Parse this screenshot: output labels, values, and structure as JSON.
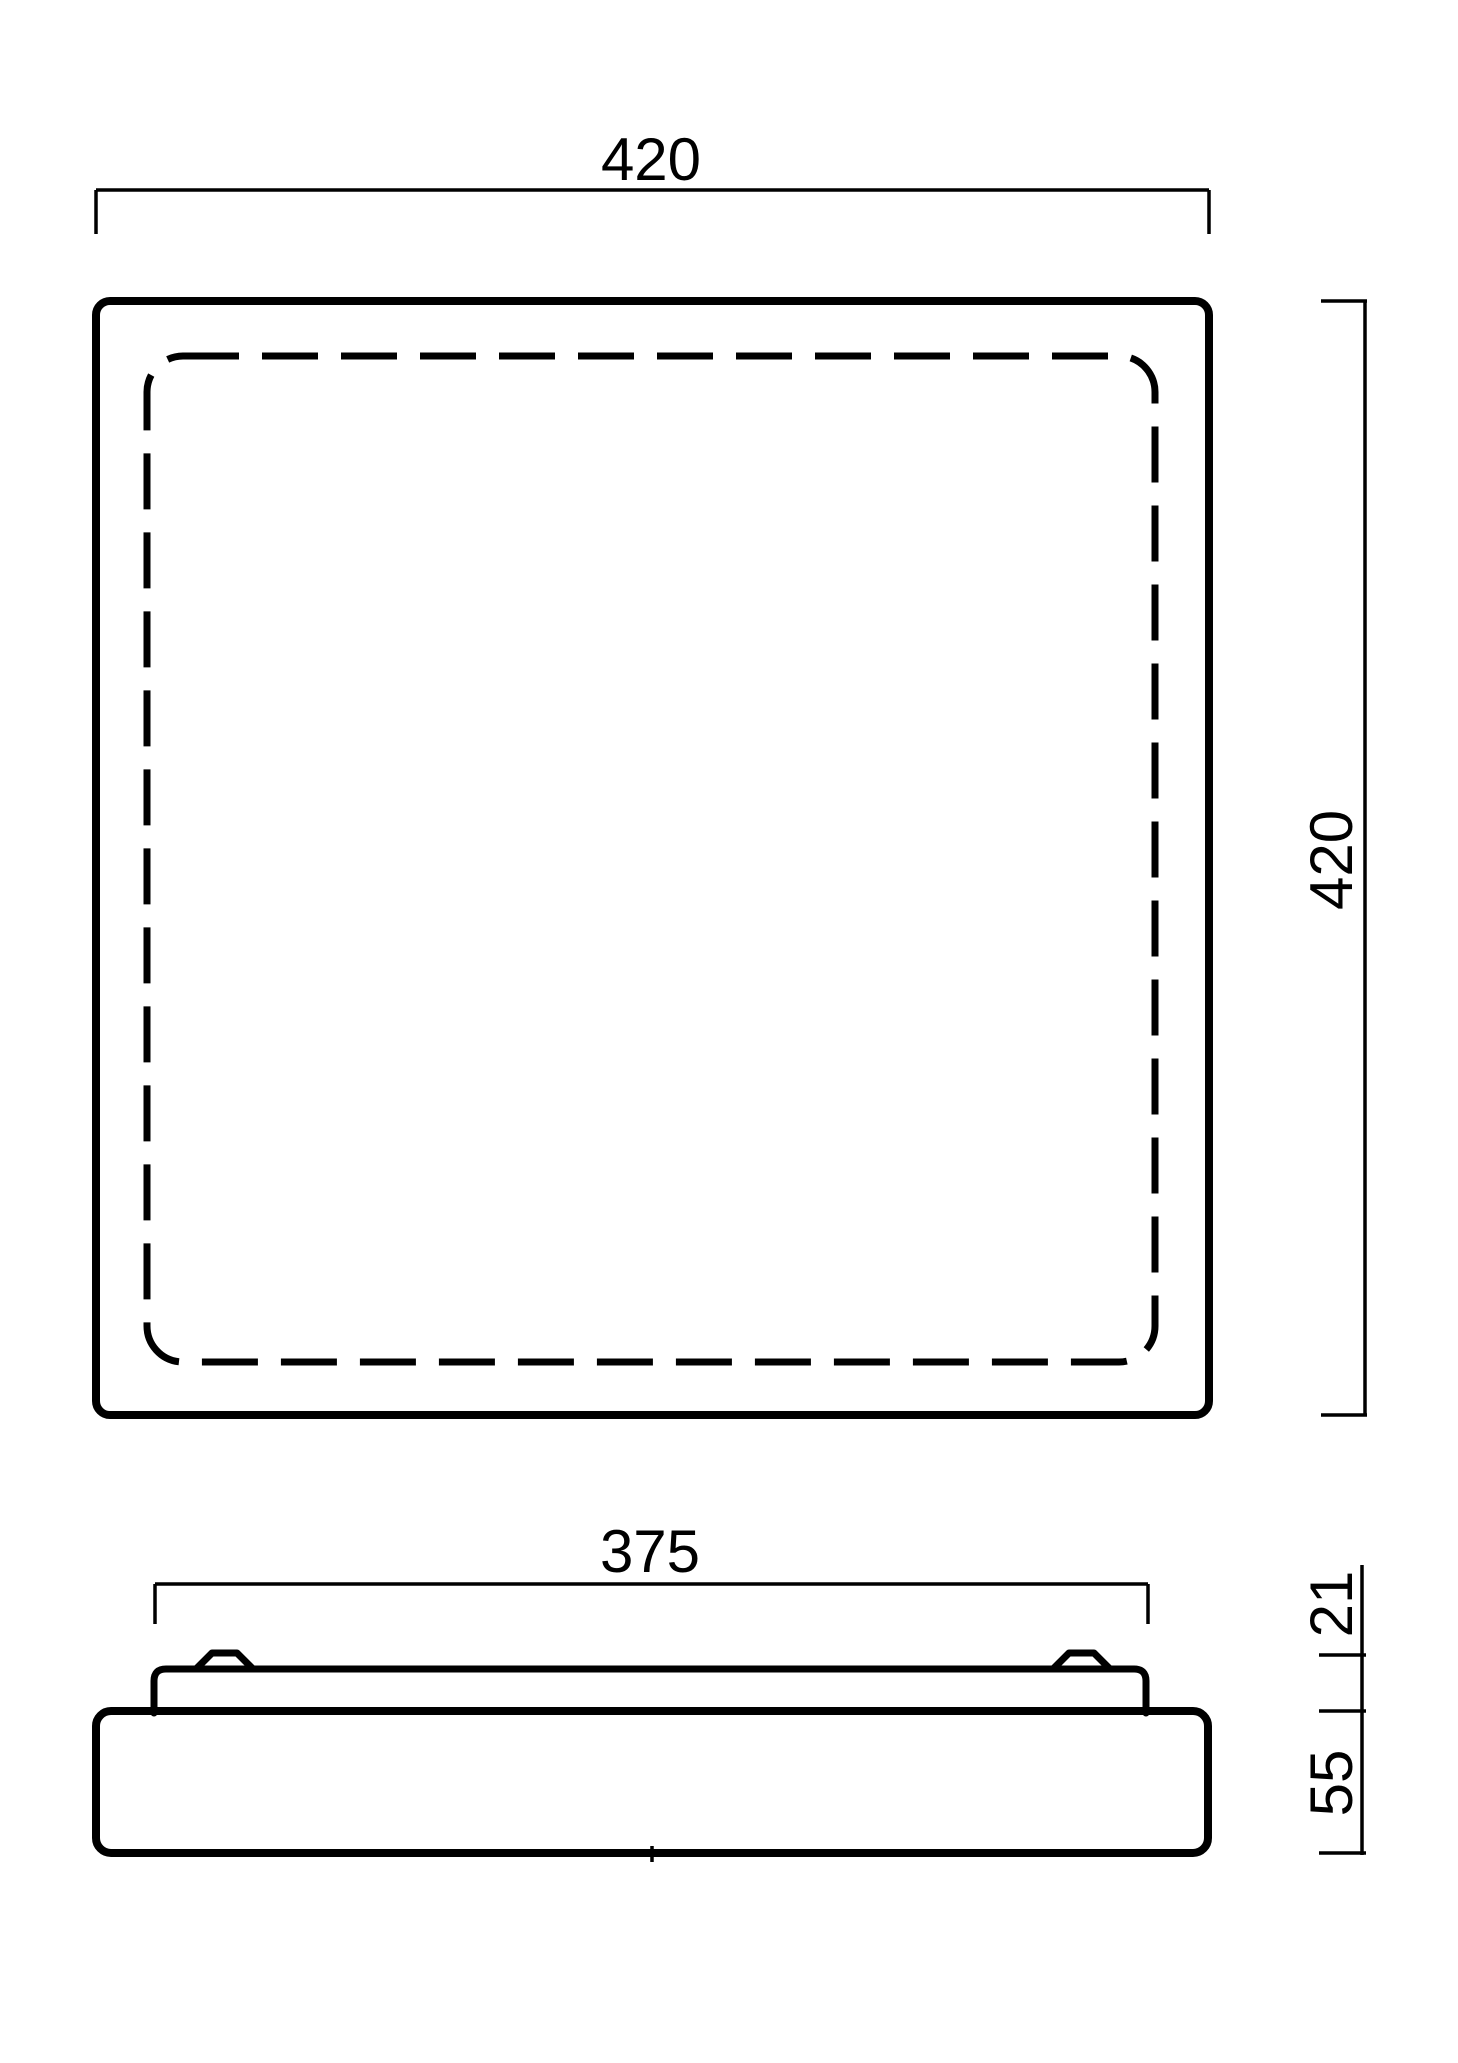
{
  "drawing": {
    "type": "technical-dimension-drawing",
    "background_color": "#ffffff",
    "line_color": "#000000",
    "views": {
      "top_view": {
        "description_name": "top-view-square-with-dashed-inner-outline"
      },
      "side_view": {
        "description_name": "side-profile-with-mounting-plate-and-clips"
      }
    },
    "dimensions": {
      "top_width": "420",
      "right_height": "420",
      "plate_width": "375",
      "upper_profile_height": "21",
      "lower_profile_height": "55"
    }
  }
}
